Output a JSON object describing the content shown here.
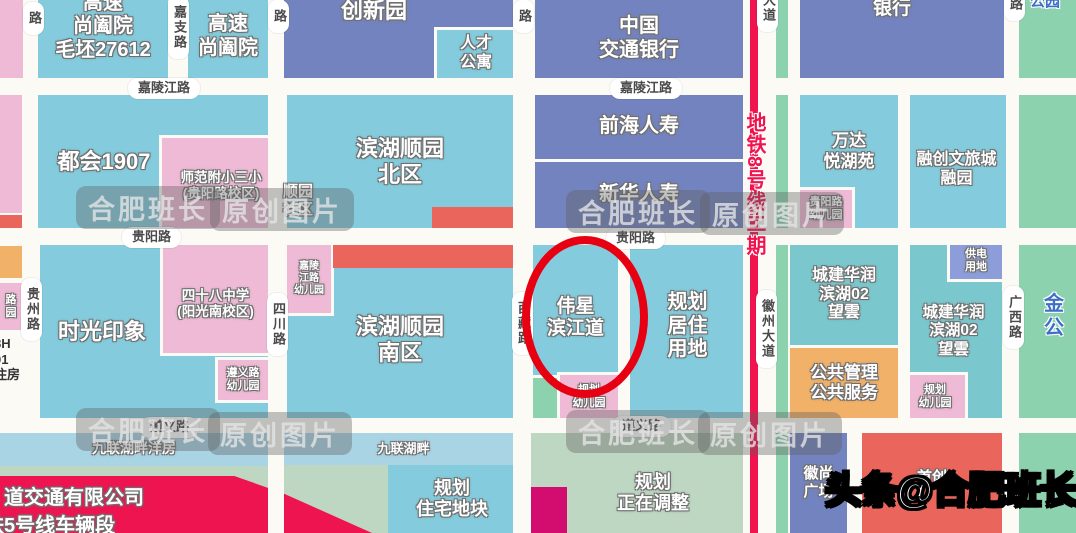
{
  "map": {
    "background": "#FBFAF5",
    "colors": {
      "parcel_cyan": "#84CCDD",
      "parcel_lightblue": "#A9D4E4",
      "parcel_blue": "#7383BF",
      "parcel_pink": "#EFBAD5",
      "parcel_green": "#8DD2AF",
      "parcel_sage": "#BED7C2",
      "parcel_teal": "#7AC8CE",
      "parcel_orange": "#F2B168",
      "parcel_periwinkle": "#8D9DD9",
      "parcel_red": "#EA655C",
      "parcel_crimson": "#ED1450",
      "parcel_magenta": "#D30D6F",
      "metro_line": "#F0134D",
      "highlight_circle": "#E60012",
      "road": "#FBFAF5",
      "road_label_text": "#4A4A4A",
      "blue_text": "#3D6FC8"
    },
    "blocks": [
      {
        "id": "corner-pink-nw",
        "x": 0,
        "y": 0,
        "w": 25,
        "h": 80,
        "c": "pink"
      },
      {
        "id": "leftedge-pink-a",
        "x": 0,
        "y": 95,
        "w": 22,
        "h": 118,
        "c": "pink"
      },
      {
        "id": "leftedge-red",
        "x": 0,
        "y": 215,
        "w": 22,
        "h": 29,
        "c": "redblock"
      },
      {
        "id": "leftedge-orange",
        "x": 0,
        "y": 246,
        "w": 22,
        "h": 32,
        "c": "orange"
      },
      {
        "id": "leftedge-kindergarten-partial",
        "x": 0,
        "y": 283,
        "w": 22,
        "h": 47,
        "c": "pink",
        "label": "路\n园",
        "fs": 11
      },
      {
        "id": "gaosu-shangheyuan-maopi",
        "x": 38,
        "y": 0,
        "w": 130,
        "h": 78,
        "c": "cyan",
        "label": "高速\n尚阖院\n毛坯27612",
        "fs": 20,
        "dy": -12
      },
      {
        "id": "gaosu-shangheyuan",
        "x": 188,
        "y": 0,
        "w": 80,
        "h": 78,
        "c": "cyan",
        "label": "高速\n尚阖院",
        "fs": 20,
        "dy": -2
      },
      {
        "id": "chuangxinyuan",
        "x": 283,
        "y": 0,
        "w": 230,
        "h": 78,
        "c": "blue",
        "label": "创新园",
        "fs": 22,
        "dx": -24,
        "dy": -28
      },
      {
        "id": "rencai-gongyu",
        "x": 437,
        "y": 30,
        "w": 78,
        "h": 48,
        "c": "cyan",
        "label": "人才\n公寓",
        "fs": 16,
        "outline": true
      },
      {
        "id": "zhongguo-jiaotong-yinhang",
        "x": 535,
        "y": 0,
        "w": 208,
        "h": 78,
        "c": "blue",
        "label": "中国\n交通银行",
        "fs": 20
      },
      {
        "id": "yinhang",
        "x": 800,
        "y": 0,
        "w": 204,
        "h": 78,
        "c": "blue",
        "label": "银行",
        "fs": 19,
        "dx": -10,
        "dy": -30
      },
      {
        "id": "strip-green-metro-east",
        "x": 776,
        "y": 0,
        "w": 12,
        "h": 533,
        "c": "green"
      },
      {
        "id": "strip-green-east-edge",
        "x": 1019,
        "y": 0,
        "w": 57,
        "h": 533,
        "c": "green"
      },
      {
        "id": "duhui-1907",
        "x": 38,
        "y": 95,
        "w": 242,
        "h": 133,
        "c": "cyan",
        "label": "都会1907",
        "fs": 22,
        "dx": -55
      },
      {
        "id": "shifan-fuxiao-sanxiao",
        "x": 162,
        "y": 138,
        "w": 118,
        "h": 90,
        "c": "pink",
        "label": "师范附小三小\n(贵阳路校区)",
        "fs": 13.5,
        "dy": 3,
        "outline": true
      },
      {
        "id": "binhu-shunyuan-beiqu",
        "x": 287,
        "y": 95,
        "w": 226,
        "h": 133,
        "c": "cyan",
        "label": "滨湖顺园\n北区",
        "fs": 22
      },
      {
        "id": "red-strip-north",
        "x": 432,
        "y": 207,
        "w": 85,
        "h": 21,
        "c": "redblock"
      },
      {
        "id": "qianhai-renshou",
        "x": 535,
        "y": 95,
        "w": 208,
        "h": 64,
        "c": "blue",
        "label": "前海人寿",
        "fs": 20
      },
      {
        "id": "xinhua-renshou",
        "x": 535,
        "y": 162,
        "w": 208,
        "h": 66,
        "c": "blue",
        "label": "新华人寿",
        "fs": 20
      },
      {
        "id": "wanda-yuehuyuan",
        "x": 800,
        "y": 95,
        "w": 98,
        "h": 133,
        "c": "cyan",
        "label": "万达\n悦湖苑",
        "fs": 17,
        "dy": -10
      },
      {
        "id": "guiyanglu-youeryuan",
        "x": 800,
        "y": 190,
        "w": 52,
        "h": 38,
        "c": "pink",
        "label": "贵阳路\n幼儿园",
        "fs": 11,
        "outline": true
      },
      {
        "id": "rongchuang-wenlvcheng",
        "x": 905,
        "y": 95,
        "w": 103,
        "h": 133,
        "c": "cyan",
        "label": "融创文旅城\n融园",
        "fs": 16,
        "dy": 8
      },
      {
        "id": "shiguang-yinxiang",
        "x": 40,
        "y": 245,
        "w": 228,
        "h": 173,
        "c": "cyan",
        "label": "时光印象",
        "fs": 22,
        "dx": -52
      },
      {
        "id": "sishiba-zhongxue",
        "x": 163,
        "y": 245,
        "w": 105,
        "h": 108,
        "c": "pink",
        "label": "四十八中学\n(阳光南校区)",
        "fs": 13.5,
        "dy": 5,
        "outline": true
      },
      {
        "id": "zunyilu-youeryuan",
        "x": 218,
        "y": 360,
        "w": 50,
        "h": 40,
        "c": "pink",
        "label": "遵义路\n幼儿园",
        "fs": 11,
        "outline": true
      },
      {
        "id": "binhu-shunyuan-nanqu",
        "x": 287,
        "y": 245,
        "w": 226,
        "h": 173,
        "c": "cyan",
        "label": "滨湖顺园\n南区",
        "fs": 22,
        "dy": 8
      },
      {
        "id": "jialingjianglu-youeryuan",
        "x": 287,
        "y": 245,
        "w": 44,
        "h": 68,
        "c": "pink",
        "label": "嘉陵\n江路\n幼儿园",
        "fs": 10,
        "outline": true
      },
      {
        "id": "red-strip-south",
        "x": 333,
        "y": 245,
        "w": 184,
        "h": 23,
        "c": "redblock"
      },
      {
        "id": "weixing-binjiangdao",
        "x": 533,
        "y": 245,
        "w": 85,
        "h": 130,
        "c": "cyan",
        "label": "伟星\n滨江道",
        "fs": 19,
        "dy": 8
      },
      {
        "id": "small-green-block",
        "x": 533,
        "y": 378,
        "w": 24,
        "h": 40,
        "c": "green"
      },
      {
        "id": "guihua-youeryuan-west",
        "x": 560,
        "y": 375,
        "w": 58,
        "h": 43,
        "c": "pink",
        "label": "规划\n幼儿园",
        "fs": 11,
        "outline": true
      },
      {
        "id": "guihua-juzhu-yongdi",
        "x": 630,
        "y": 245,
        "w": 115,
        "h": 173,
        "c": "cyan",
        "label": "规划\n居住\n用地",
        "fs": 20,
        "dy": -5
      },
      {
        "id": "chengjian-huarun-wangyun-1",
        "x": 790,
        "y": 245,
        "w": 108,
        "h": 100,
        "c": "teal",
        "label": "城建华润\n滨湖02\n望雲",
        "fs": 16
      },
      {
        "id": "gonggong-guanli-fuwu",
        "x": 790,
        "y": 348,
        "w": 108,
        "h": 70,
        "c": "orange",
        "label": "公共管理\n公共服务",
        "fs": 17
      },
      {
        "id": "chengjian-huarun-wangyun-2",
        "x": 905,
        "y": 245,
        "w": 97,
        "h": 173,
        "c": "teal",
        "label": "城建华润\n滨湖02\n望雲",
        "fs": 15.5
      },
      {
        "id": "gongdian-yongdi",
        "x": 950,
        "y": 243,
        "w": 52,
        "h": 36,
        "c": "periwinkle",
        "label": "供电\n用地",
        "fs": 11,
        "outline": true
      },
      {
        "id": "guihua-youeryuan-east",
        "x": 905,
        "y": 375,
        "w": 60,
        "h": 43,
        "c": "pink",
        "label": "规划\n幼儿园",
        "fs": 11,
        "outline": true
      },
      {
        "id": "jiulian-hupan-yangfang",
        "x": 0,
        "y": 433,
        "w": 268,
        "h": 33,
        "c": "lightblue",
        "label": "九联湖畔洋房",
        "fs": 14,
        "dy": -1
      },
      {
        "id": "sage-area-west",
        "x": 0,
        "y": 466,
        "w": 268,
        "h": 67,
        "c": "sage"
      },
      {
        "id": "jiulian-hupan",
        "x": 284,
        "y": 433,
        "w": 229,
        "h": 32,
        "c": "lightblue",
        "label": "九联湖畔",
        "fs": 13,
        "dx": 5
      },
      {
        "id": "sage-area-mid",
        "x": 284,
        "y": 465,
        "w": 229,
        "h": 68,
        "c": "sage"
      },
      {
        "id": "guihua-zhuzhai-dikuai",
        "x": 388,
        "y": 465,
        "w": 128,
        "h": 68,
        "c": "cyan",
        "label": "规划\n住宅地块",
        "fs": 18
      },
      {
        "id": "guihua-zhengzai-tiaozheng",
        "x": 525,
        "y": 433,
        "w": 220,
        "h": 100,
        "c": "sage",
        "label": "规划\n正在调整",
        "fs": 18,
        "dx": 18,
        "dy": 10
      },
      {
        "id": "magenta-block",
        "x": 527,
        "y": 487,
        "w": 40,
        "h": 46,
        "c": "magenta"
      },
      {
        "id": "rail-company-wedge",
        "x": 0,
        "y": 476,
        "w": 372,
        "h": 57,
        "c": "crimson",
        "shape": "wedge"
      },
      {
        "id": "huishang-guangchang",
        "x": 790,
        "y": 433,
        "w": 57,
        "h": 100,
        "c": "blue",
        "label": "徽尚\n广场",
        "fs": 15
      },
      {
        "id": "shouchuang",
        "x": 862,
        "y": 433,
        "w": 140,
        "h": 100,
        "c": "redblock",
        "label": "首创",
        "fs": 15,
        "dy": -5
      }
    ],
    "roads": {
      "horizontal": [
        {
          "id": "jialingjiang-road",
          "y": 78,
          "h": 17
        },
        {
          "id": "guiyang-road",
          "y": 228,
          "h": 17
        },
        {
          "id": "zunyi-road",
          "y": 418,
          "h": 15
        }
      ],
      "vertical": [
        {
          "id": "guizhou-road",
          "x": 23,
          "w": 15,
          "y": 0,
          "h": 418
        },
        {
          "id": "jiazhi-road",
          "x": 169,
          "w": 18,
          "y": 0,
          "h": 78
        },
        {
          "id": "sichuan-road",
          "x": 268,
          "w": 16,
          "y": 0,
          "h": 533
        },
        {
          "id": "xizang-road",
          "x": 513,
          "w": 18,
          "y": 0,
          "h": 533
        },
        {
          "id": "huizhou-avenue",
          "x": 743,
          "w": 32,
          "y": 0,
          "h": 533
        },
        {
          "id": "road-wanda-rongchuang",
          "x": 898,
          "w": 12,
          "y": 78,
          "h": 340
        },
        {
          "id": "road-huishang-shouchuang",
          "x": 849,
          "w": 12,
          "y": 433,
          "h": 100
        },
        {
          "id": "guangxi-road",
          "x": 1006,
          "w": 13,
          "y": 0,
          "h": 533
        }
      ]
    },
    "metro_line": {
      "id": "metro-line-8",
      "x": 750,
      "w": 8,
      "y": 0,
      "h": 533,
      "color": "#F0134D"
    },
    "road_labels": [
      {
        "id": "jialingjiang-label-1",
        "text": "嘉陵江路",
        "x": 128,
        "y": 78,
        "v": false
      },
      {
        "id": "jialingjiang-label-2",
        "text": "嘉陵江路",
        "x": 610,
        "y": 78,
        "v": false
      },
      {
        "id": "guiyang-label-1",
        "text": "贵阳路",
        "x": 122,
        "y": 227,
        "v": false
      },
      {
        "id": "guiyang-label-2",
        "text": "贵阳路",
        "x": 606,
        "y": 228,
        "v": false
      },
      {
        "id": "zunyi-label-1",
        "text": "遵义路",
        "x": 140,
        "y": 417,
        "v": false
      },
      {
        "id": "zunyi-label-2",
        "text": "遵义路",
        "x": 612,
        "y": 416,
        "v": false
      },
      {
        "id": "lu-label-nw",
        "text": "路",
        "x": 23,
        "y": 2,
        "v": true
      },
      {
        "id": "jiazhi-label",
        "text": "嘉支路",
        "x": 168,
        "y": -4,
        "v": true
      },
      {
        "id": "lu-label-sichuan-top",
        "text": "路",
        "x": 268,
        "y": 0,
        "v": true
      },
      {
        "id": "guizhou-label",
        "text": "贵州路",
        "x": 21,
        "y": 278,
        "v": true
      },
      {
        "id": "sichuan-label",
        "text": "四川路",
        "x": 267,
        "y": 293,
        "v": true
      },
      {
        "id": "lu-label-xizang-top",
        "text": "路",
        "x": 513,
        "y": 0,
        "v": true
      },
      {
        "id": "xizang-label",
        "text": "西藏路",
        "x": 512,
        "y": 292,
        "v": true
      },
      {
        "id": "dadao-label-top",
        "text": "大道",
        "x": 757,
        "y": -16,
        "v": true
      },
      {
        "id": "huizhou-dadao-label",
        "text": "徽州大道",
        "x": 756,
        "y": 290,
        "v": true
      },
      {
        "id": "lu-label-ne",
        "text": "路",
        "x": 1004,
        "y": -12,
        "v": true
      },
      {
        "id": "guangxi-label",
        "text": "广西路",
        "x": 1003,
        "y": 286,
        "v": true
      }
    ],
    "texts": [
      {
        "id": "shunyuan-shequ",
        "text": "顺园\n社区",
        "x": 283,
        "y": 183,
        "fs": 15,
        "cls": "t-white"
      },
      {
        "id": "gongyuan",
        "text": "公园",
        "x": 1030,
        "y": -7,
        "fs": 15,
        "cls": "t-blue"
      },
      {
        "id": "jingong",
        "text": "金\n公",
        "x": 1044,
        "y": 292,
        "fs": 20,
        "cls": "t-blue"
      },
      {
        "id": "metro-8-line-phase2",
        "text": "地铁8号线二期",
        "x": 742,
        "y": 112,
        "fs": 20,
        "cls": "t-metro"
      },
      {
        "id": "rail-company-line1",
        "text": "道交通有限公司",
        "x": 4,
        "y": 486,
        "fs": 20,
        "cls": "t-white"
      },
      {
        "id": "rail-company-line2",
        "text": "铁5号线车辆段",
        "x": -16,
        "y": 514,
        "fs": 20,
        "cls": "t-white"
      },
      {
        "id": "leftedge-8h01",
        "text": "8H\n01\n住房",
        "x": -6,
        "y": 336,
        "fs": 13,
        "cls": "t-dark"
      }
    ],
    "watermarks": [
      {
        "id": "wm-1a",
        "text": "合肥班长",
        "x": 76,
        "y": 186
      },
      {
        "id": "wm-1b",
        "text": "原创图片",
        "x": 210,
        "y": 188
      },
      {
        "id": "wm-2a",
        "text": "合肥班长",
        "x": 566,
        "y": 190
      },
      {
        "id": "wm-2b",
        "text": "原创图片",
        "x": 700,
        "y": 192
      },
      {
        "id": "wm-3a",
        "text": "合肥班长",
        "x": 76,
        "y": 408
      },
      {
        "id": "wm-3b",
        "text": "原创图片",
        "x": 208,
        "y": 412
      },
      {
        "id": "wm-4a",
        "text": "合肥班长",
        "x": 566,
        "y": 410
      },
      {
        "id": "wm-4b",
        "text": "原创图片",
        "x": 698,
        "y": 412
      }
    ],
    "annotation": {
      "highlight_ellipse": {
        "x": 522,
        "y": 236,
        "w": 110,
        "h": 146,
        "stroke": "#E60012",
        "stroke_width": 8,
        "target": "伟星滨江道"
      }
    },
    "byline": {
      "text": "头条@合肥班长"
    }
  }
}
